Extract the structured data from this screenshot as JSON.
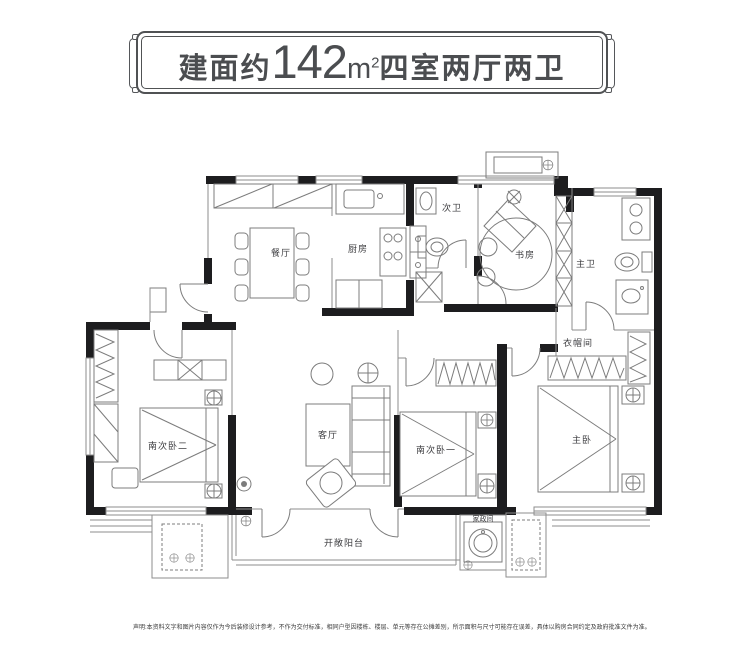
{
  "title": {
    "prefix": "建面约",
    "area": "142",
    "unit_base": "m",
    "unit_sup": "2",
    "suffix": "四室两厅两卫"
  },
  "rooms": {
    "dining": "餐厅",
    "kitchen": "厨房",
    "guest_bath": "次卫",
    "study": "书房",
    "master_bath": "主卫",
    "closet": "衣帽间",
    "bedroom2": "南次卧二",
    "living": "客厅",
    "bedroom1": "南次卧一",
    "master_bedroom": "主卧",
    "laundry": "家政间",
    "balcony": "开敞阳台"
  },
  "disclaimer": "声明:本资料文字和图片内容仅作为今后装修设计参考，不作为交付标准，相同户型因楼栋、楼层、单元等存在公摊差别，所示面积与尺寸可能存在误差，具体以购房合同约定及政府批准文件为准。",
  "colors": {
    "wall": "#1d1d1f",
    "line": "#8d8d8d",
    "text": "#4b4d50"
  }
}
